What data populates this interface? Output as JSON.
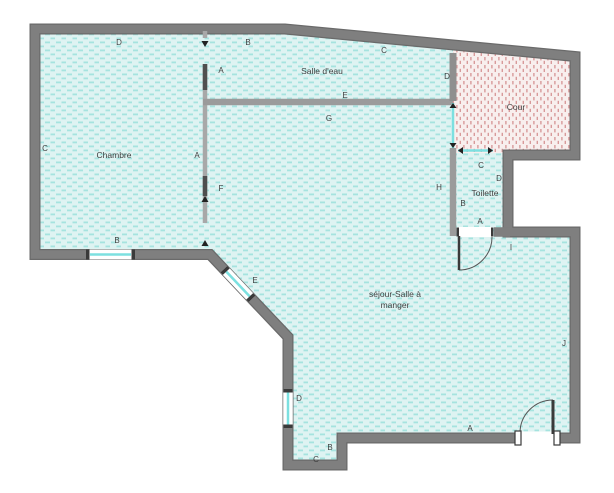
{
  "plan_title": "floor-plan",
  "rooms": {
    "chambre": "Chambre",
    "salle_deau": "Salle d'eau",
    "cour": "Cour",
    "toilette": "Toilette",
    "sejour_line1": "séjour-Salle à",
    "sejour_line2": "manger"
  },
  "markers": [
    {
      "text": "D"
    },
    {
      "text": "B"
    },
    {
      "text": "C"
    },
    {
      "text": "A"
    },
    {
      "text": "D"
    },
    {
      "text": "E"
    },
    {
      "text": "G"
    },
    {
      "text": "C"
    },
    {
      "text": "A"
    },
    {
      "text": "C"
    },
    {
      "text": "D"
    },
    {
      "text": "H"
    },
    {
      "text": "F"
    },
    {
      "text": "B"
    },
    {
      "text": "A"
    },
    {
      "text": "B"
    },
    {
      "text": "I"
    },
    {
      "text": "E"
    },
    {
      "text": "J"
    },
    {
      "text": "D"
    },
    {
      "text": "A"
    },
    {
      "text": "B"
    },
    {
      "text": "C"
    }
  ],
  "colors": {
    "outer_wall": "#7c7c7c",
    "outer_wall_edge": "#6a6a6a",
    "interior_wall": "#a8a8a8",
    "partition_wall": "#9b9b9b",
    "floor_bg": "#def3f2",
    "floor_dash": "#a5e3df",
    "cour_bg": "#f8efee",
    "cour_dash": "#d89a9a",
    "window_glass": "#7ce0e0",
    "door_leaf": "#3a3a3a",
    "label_text": "#3f3f3f"
  }
}
